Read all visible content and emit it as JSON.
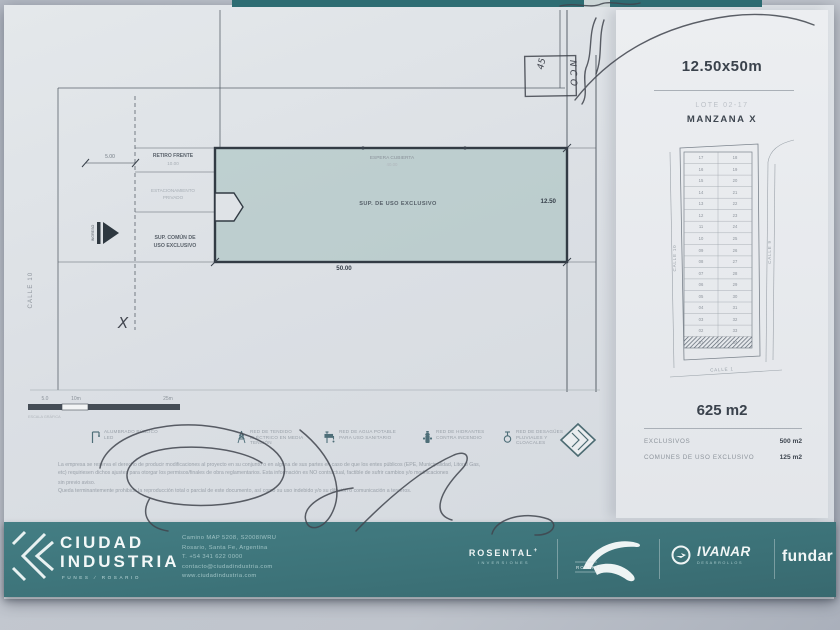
{
  "panel": {
    "size": "12.50x50m",
    "lot": "LOTE 02-17",
    "block": "MANZANA X",
    "total_area": "625 m2",
    "rows": [
      {
        "label": "EXCLUSIVOS",
        "value": "500 m2"
      },
      {
        "label": "COMUNES DE USO EXCLUSIVO",
        "value": "125 m2"
      }
    ]
  },
  "minimap": {
    "street_left": "CALLE 10",
    "street_right": "CALLE 9",
    "street_bottom": "CALLE 1",
    "left_column": [
      "17",
      "16",
      "15",
      "14",
      "13",
      "12",
      "11",
      "10",
      "09",
      "08",
      "07",
      "06",
      "05",
      "04",
      "03",
      "02",
      "01"
    ],
    "right_column": [
      "18",
      "19",
      "20",
      "21",
      "22",
      "23",
      "24",
      "25",
      "26",
      "27",
      "28",
      "29",
      "30",
      "31",
      "32",
      "33",
      "34"
    ]
  },
  "plan": {
    "street_left": "CALLE 10",
    "retiro_label": "RETIRO FRENTE",
    "retiro_dim": "10.00",
    "estacionamiento_line1": "ESTACIONAMIENTO",
    "estacionamiento_line2": "PRIVADO",
    "sup_comun_line1": "SUP. COMÚN DE",
    "sup_comun_line2": "USO EXCLUSIVO",
    "espera_label": "ESPERA CUBIERTA",
    "espera_dim": "40.00",
    "sup_exclusivo_label": "SUP. DE USO EXCLUSIVO",
    "width_dim": "12.50",
    "length_dim": "50.00",
    "setback_dim": "5.00",
    "ingreso_label": "INGRESO"
  },
  "scalebar": {
    "label_1": "5.0",
    "label_2": "10m",
    "label_3": "25m",
    "caption": "ESCALA GRÁFICA"
  },
  "legend_items": [
    {
      "icon": "streetlight-icon",
      "label": "ALUMBRADO PÚBLICO LED"
    },
    {
      "icon": "power-tower-icon",
      "label": "RED DE TENDIDO ELÉCTRICO EN MEDIA TENSIÓN"
    },
    {
      "icon": "faucet-icon",
      "label": "RED DE AGUA POTABLE PARA USO SANITARIO"
    },
    {
      "icon": "hydrant-icon",
      "label": "RED DE HIDRANTES CONTRA INCENDIO"
    },
    {
      "icon": "drain-icon",
      "label": "RED DE DESAGÜES PLUVIALES Y CLOACALES"
    }
  ],
  "disclaimer": [
    "La empresa se reserva el derecho de producir modificaciones al proyecto en su conjunto o en alguna de sus partes en caso de que los entes públicos (EPE, Municipalidad, Litoral Gas,",
    "etc) requiriesen dichos ajustes para otorgar los permisos/finales de obra reglamentarios. Esta información es NO contractual, factible de sufrir cambios y/o modificaciones",
    "sin previo aviso.",
    "Queda terminantemente prohibida la reproducción total o parcial de este documento, así como su uso indebido y/o su difusión o comunicación a terceros."
  ],
  "annotations": {
    "number": "45",
    "vertical_text": "NCO",
    "x_mark": "X"
  },
  "footer": {
    "brand_line1": "CIUDAD",
    "brand_line2": "INDUSTRIA",
    "brand_sub": "FUNES ∕ ROSARIO",
    "contact": [
      "Camino MAP 5208, S2008IWRU",
      "Rosario, Santa Fe, Argentina",
      "T. +54 341 622 0000",
      "contacto@ciudadindustria.com",
      "www.ciudadindustria.com"
    ],
    "partners": {
      "rosental": "ROSENTAL",
      "rosental_plus": "+",
      "rosental_sub": "INVERSIONES",
      "road_logo_caption": "ROSITTI",
      "ivanar": "IVANAR",
      "ivanar_sub": "DESARROLLOS",
      "fundar": "fundar"
    }
  }
}
